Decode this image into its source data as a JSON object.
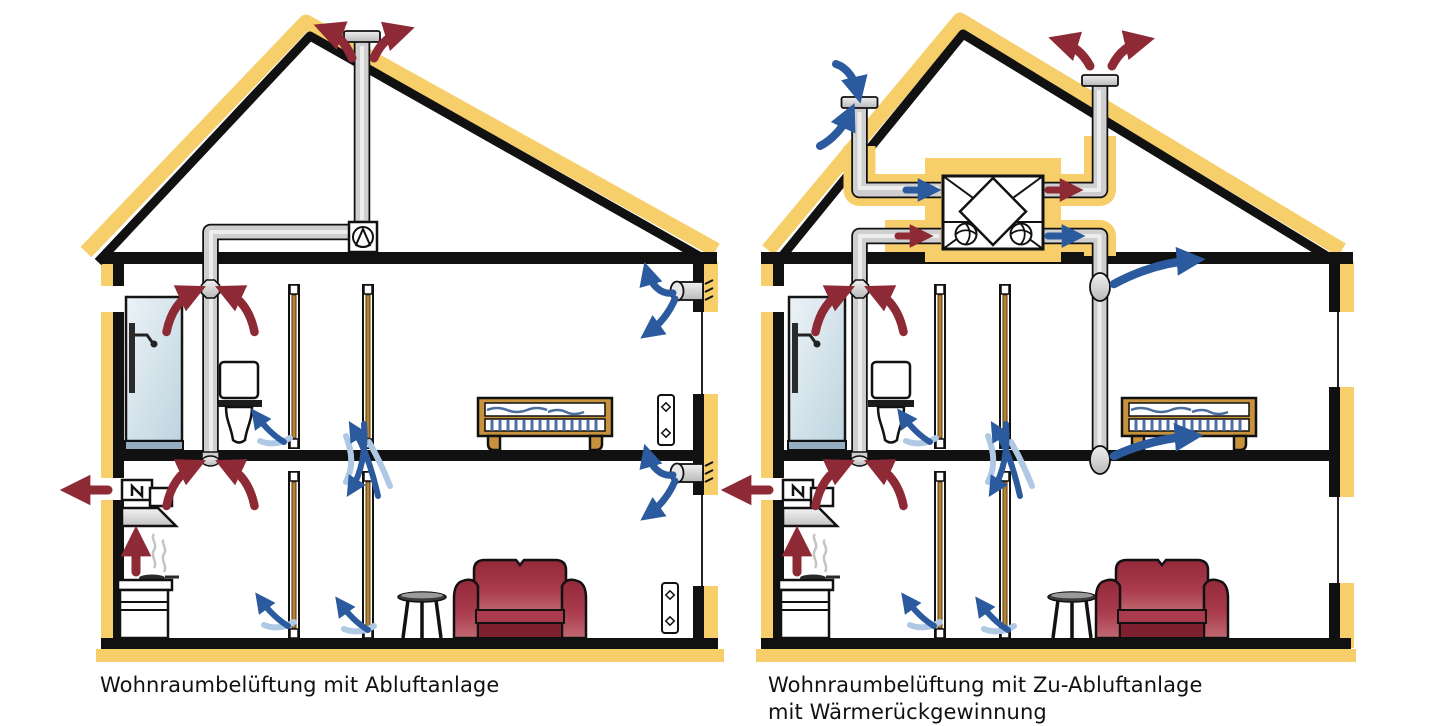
{
  "captions": {
    "left": "Wohnraumbelüftung mit Abluftanlage",
    "right": "Wohnraumbelüftung mit Zu-Abluftanlage mit Wärmerückgewinnung"
  },
  "colors": {
    "insulation_yellow": "#F6CE6A",
    "wall_black": "#111111",
    "pipe_gray": "#CFCFCF",
    "exhaust_air_red": "#8E2A36",
    "supply_air_blue": "#2B5B9E",
    "transfer_air_lightblue": "#AFC8E4",
    "wood_brown": "#C8923C",
    "sofa_red": "#9D3040",
    "shower_glass_blue": "#D9E6EC"
  },
  "houses": {
    "left": {
      "elements": [
        "roof-vent-cap",
        "exhaust-air-arrows",
        "extract-fan",
        "duct-pipe",
        "bathroom-extract-valve",
        "shower",
        "toilet",
        "bed",
        "wall-vent",
        "window",
        "door",
        "kitchen-range-hood",
        "stove",
        "sofa",
        "side-table",
        "window-plate"
      ]
    },
    "right": {
      "elements": [
        "intake-roof-cap",
        "exhaust-roof-cap",
        "heat-exchanger-unit",
        "fan",
        "supply-duct",
        "exhaust-duct",
        "supply-air-outlet",
        "bathroom-extract-valve",
        "shower",
        "toilet",
        "bed",
        "window",
        "door",
        "kitchen-range-hood",
        "stove",
        "sofa",
        "side-table"
      ]
    }
  },
  "icons": [
    "exhaust-air-arrow",
    "supply-air-arrow",
    "transfer-air-arrow",
    "extract-fan-icon",
    "heat-exchanger-icon",
    "fan-icon",
    "roof-vent-icon",
    "wall-vent-icon",
    "range-hood-icon",
    "shower-icon",
    "steam-icon"
  ]
}
